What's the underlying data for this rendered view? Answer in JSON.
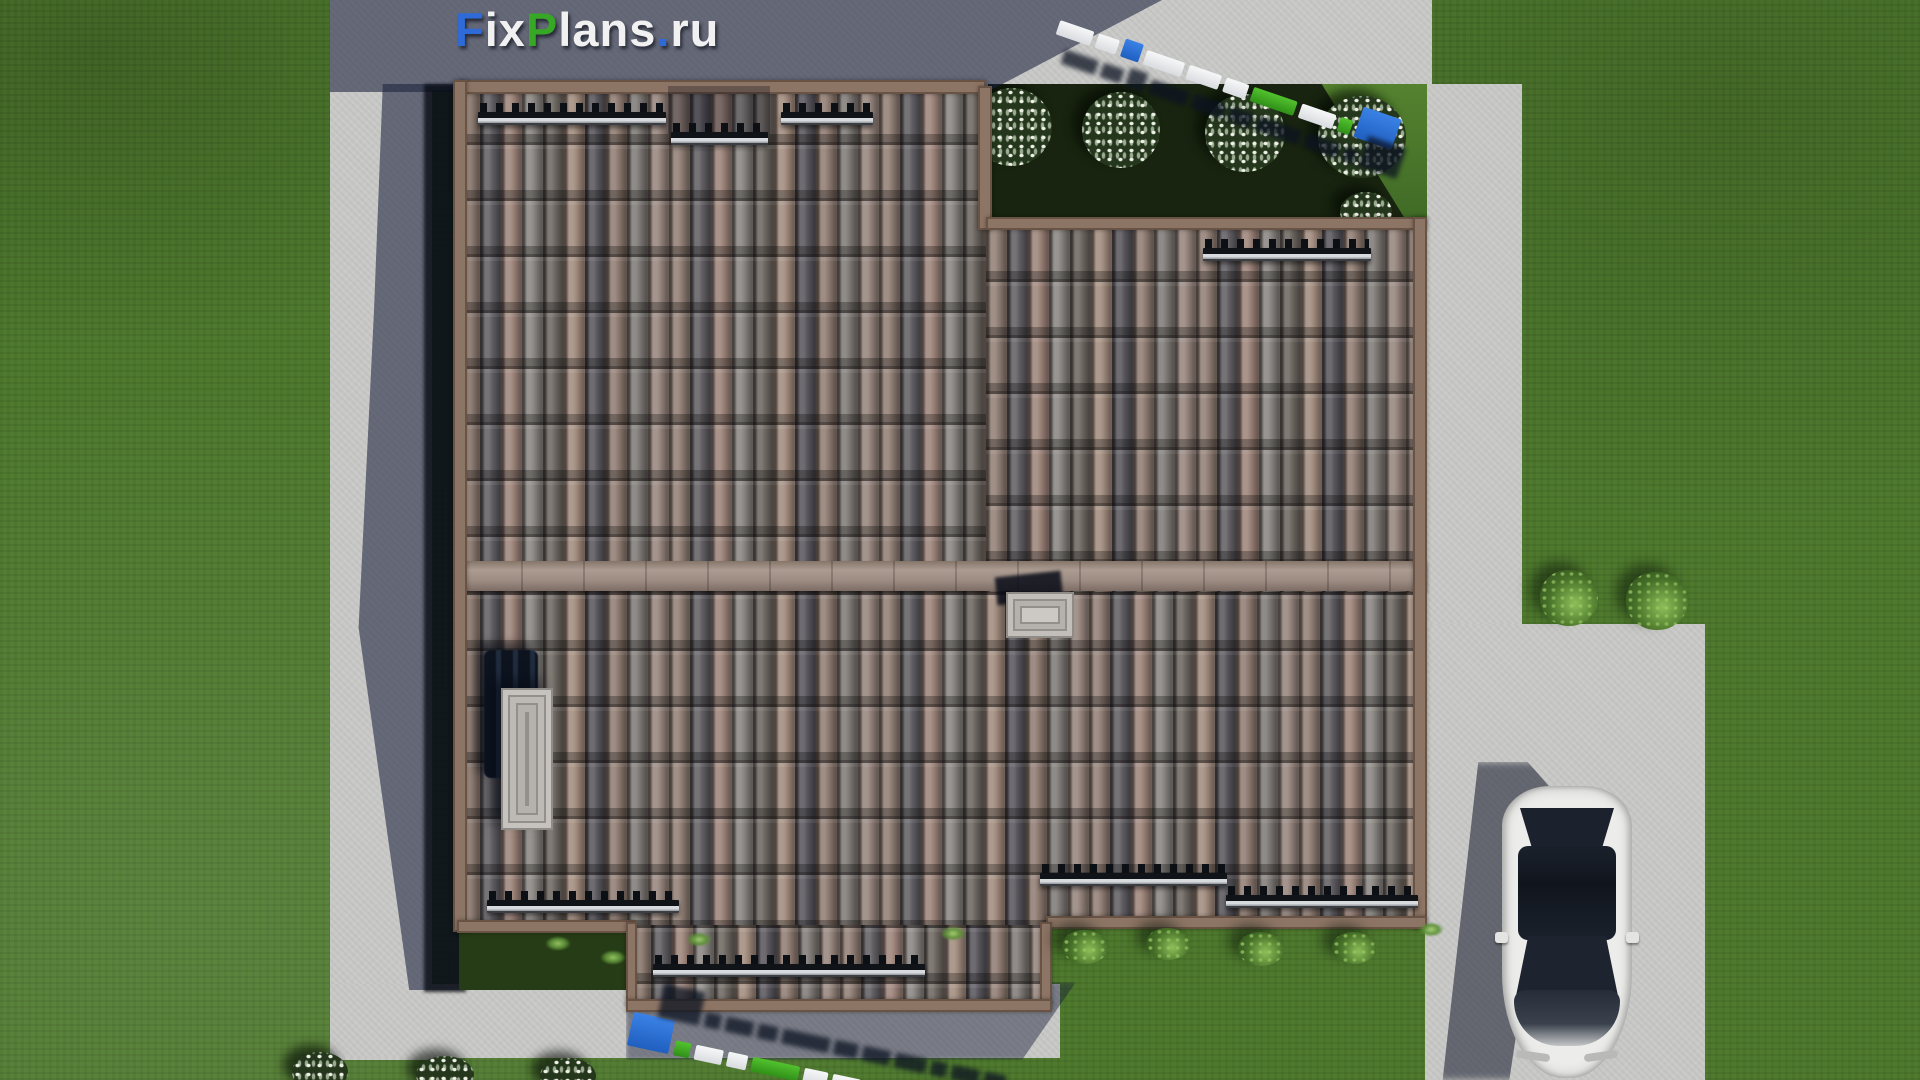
{
  "watermark": {
    "brand": "FixPlans.ru",
    "parts": [
      {
        "text": "F",
        "color": "#2e6bd8"
      },
      {
        "text": "ix",
        "color": "#f1f1f1"
      },
      {
        "text": "P",
        "color": "#37a825"
      },
      {
        "text": "lans",
        "color": "#f1f1f1"
      },
      {
        "text": ".",
        "color": "#2e6bd8"
      },
      {
        "text": "ru",
        "color": "#f1f1f1"
      }
    ]
  },
  "palette": {
    "lawn": "#4f7a2e",
    "lawn_shaded": "#1d2b13",
    "concrete": "#c8c8c6",
    "cast_shadow": "#1c233e",
    "roof_fascia": "#8d7565",
    "roof_ridge": "#9c8c82",
    "tile_gray": "#5e5c60",
    "tile_pink": "#9a8177",
    "tile_tan": "#8d7d73",
    "snow_guard_rail": "#d8dbde",
    "skylight_frame": "#ccc8c4",
    "car_body": "#ececea",
    "car_glass": "#1c222d",
    "logo_blue": "#2e6bd8",
    "logo_green": "#37a825",
    "logo_white": "#f1f1f1"
  }
}
